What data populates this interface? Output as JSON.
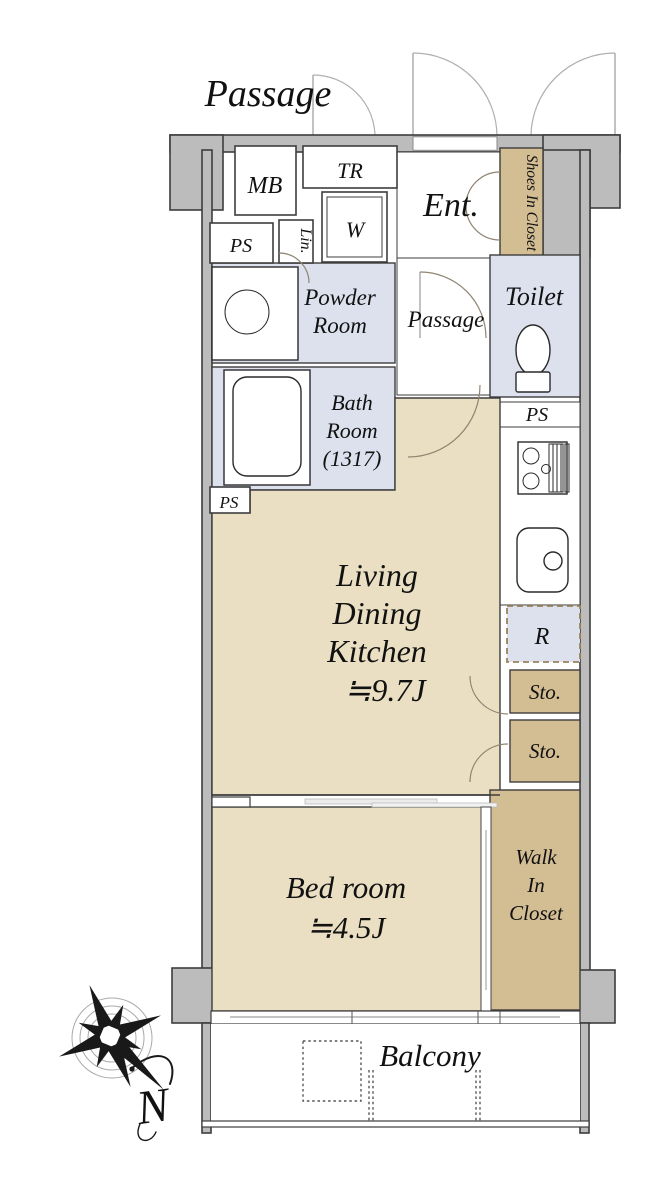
{
  "colors": {
    "wall": "#bcbcbc",
    "outline": "#3d3d3d",
    "floor": "#eadfc2",
    "closet": "#d3bd93",
    "wet": "#dde1ee",
    "door": "#8f8472"
  },
  "labels": {
    "corridor": "Passage",
    "mb": "MB",
    "tr": "TR",
    "ent": "Ent.",
    "shoes_closet": "Shoes In Closet",
    "ps_top": "PS",
    "lin": "Lin.",
    "washer": "W",
    "powder_1": "Powder",
    "powder_2": "Room",
    "inner_passage": "Passage",
    "toilet": "Toilet",
    "ps_toilet": "PS",
    "bath_1": "Bath",
    "bath_2": "Room",
    "bath_3": "(1317)",
    "ps_bath": "PS",
    "ldk_1": "Living",
    "ldk_2": "Dining",
    "ldk_3": "Kitchen",
    "ldk_4": "≒9.7J",
    "fridge": "R",
    "sto_1": "Sto.",
    "sto_2": "Sto.",
    "bed_1": "Bed room",
    "bed_2": "≒4.5J",
    "wic_1": "Walk",
    "wic_2": "In",
    "wic_3": "Closet",
    "balcony": "Balcony",
    "compass_north": "N"
  }
}
